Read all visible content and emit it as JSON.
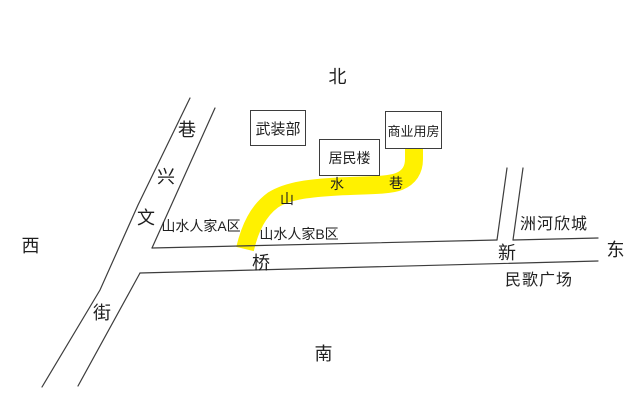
{
  "compass": {
    "north": "北",
    "south": "南",
    "west": "西",
    "east": "东"
  },
  "buildings": [
    {
      "label": "武装部"
    },
    {
      "label": "居民楼"
    },
    {
      "label": "商业用房"
    }
  ],
  "roads": {
    "diagonal_chars": [
      "巷",
      "兴",
      "文",
      "街"
    ],
    "main_chars": [
      "桥",
      "新"
    ],
    "yellow_road_chars": [
      "山",
      "水",
      "巷"
    ],
    "yellow_color": "#FFF100",
    "line_color": "#3d3d3d"
  },
  "areas": [
    {
      "label": "山水人家A区"
    },
    {
      "label": "山水人家B区"
    },
    {
      "label": "洲河欣城"
    },
    {
      "label": "民歌广场"
    }
  ]
}
